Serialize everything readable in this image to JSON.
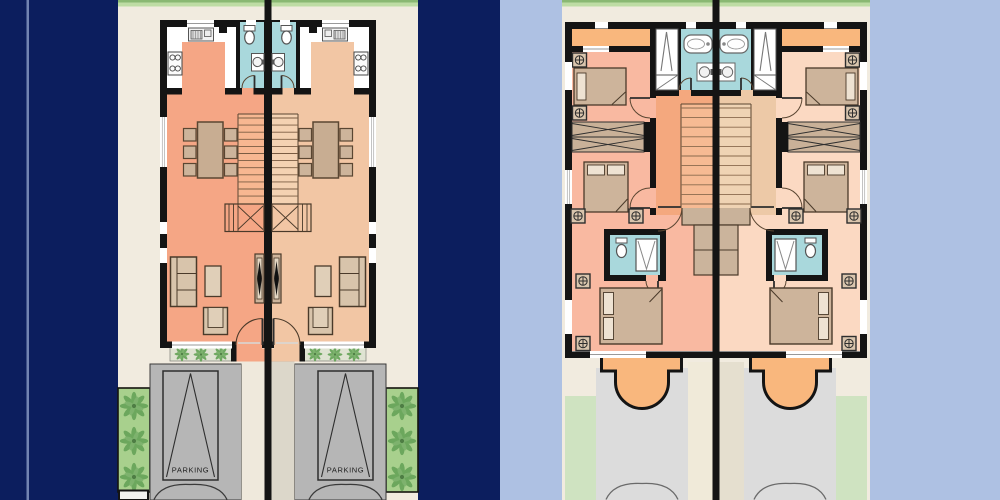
{
  "canvas": {
    "width": 1000,
    "height": 500
  },
  "labels": {
    "parking_a": "PARKING",
    "parking_b": "PARKING"
  },
  "panels": {
    "left": {
      "name": "ground-floor-duplex-site-plan",
      "background": "#0c1e5e"
    },
    "right": {
      "name": "first-floor-duplex-site-plan",
      "background": "#aec1e3"
    }
  },
  "palette": {
    "navy_background": "#0c1e5e",
    "periwinkle_background": "#aec1e3",
    "site_cream": "#f1ebdf",
    "grass_strip": "#bedca4",
    "grass_edge": "#8ab873",
    "wall_black": "#141414",
    "unit_a_floor": "#f5a685",
    "unit_b_floor": "#f2c6a4",
    "bathroom_teal": "#a9d8dc",
    "furniture_tan": "#cdb49b",
    "table_tan": "#c8ad92",
    "parking_gray": "#b6b6b6",
    "palm_strip_green": "#a8d08d",
    "palm_leaf_green": "#69a55b",
    "driveway_gray": "#dcdcdc",
    "lawn_green": "#cfe3c1",
    "balcony_orange": "#f9b77d",
    "bedroom_a_pink": "#f9b9a1",
    "bedroom_b_peach": "#fbd9c2",
    "hall_a_orange": "#f4a87e",
    "hall_b_tan": "#edc9a7",
    "wardrobe_tan": "#c9b198",
    "walkway_cream": "#efe9dc"
  },
  "icons": {
    "palm-tree-icon": "radial leaf cluster",
    "nightstand-lamp-icon": "square with circled cross",
    "kitchen-sink-icon": "counter box with basin",
    "stove-icon": "box with 4 burners",
    "toilet-icon": "tank + oval bowl",
    "washbasin-icon": "square with round basin",
    "bathtub-icon": "rounded rect with oval",
    "shower-icon": "square with V",
    "closet-icon": "tall rect with V rod lines",
    "tv-icon": "black diamond on console",
    "door-arc": "quarter-circle swing",
    "gate-arc": "double swing arcs",
    "stairs": "parallel treads"
  }
}
